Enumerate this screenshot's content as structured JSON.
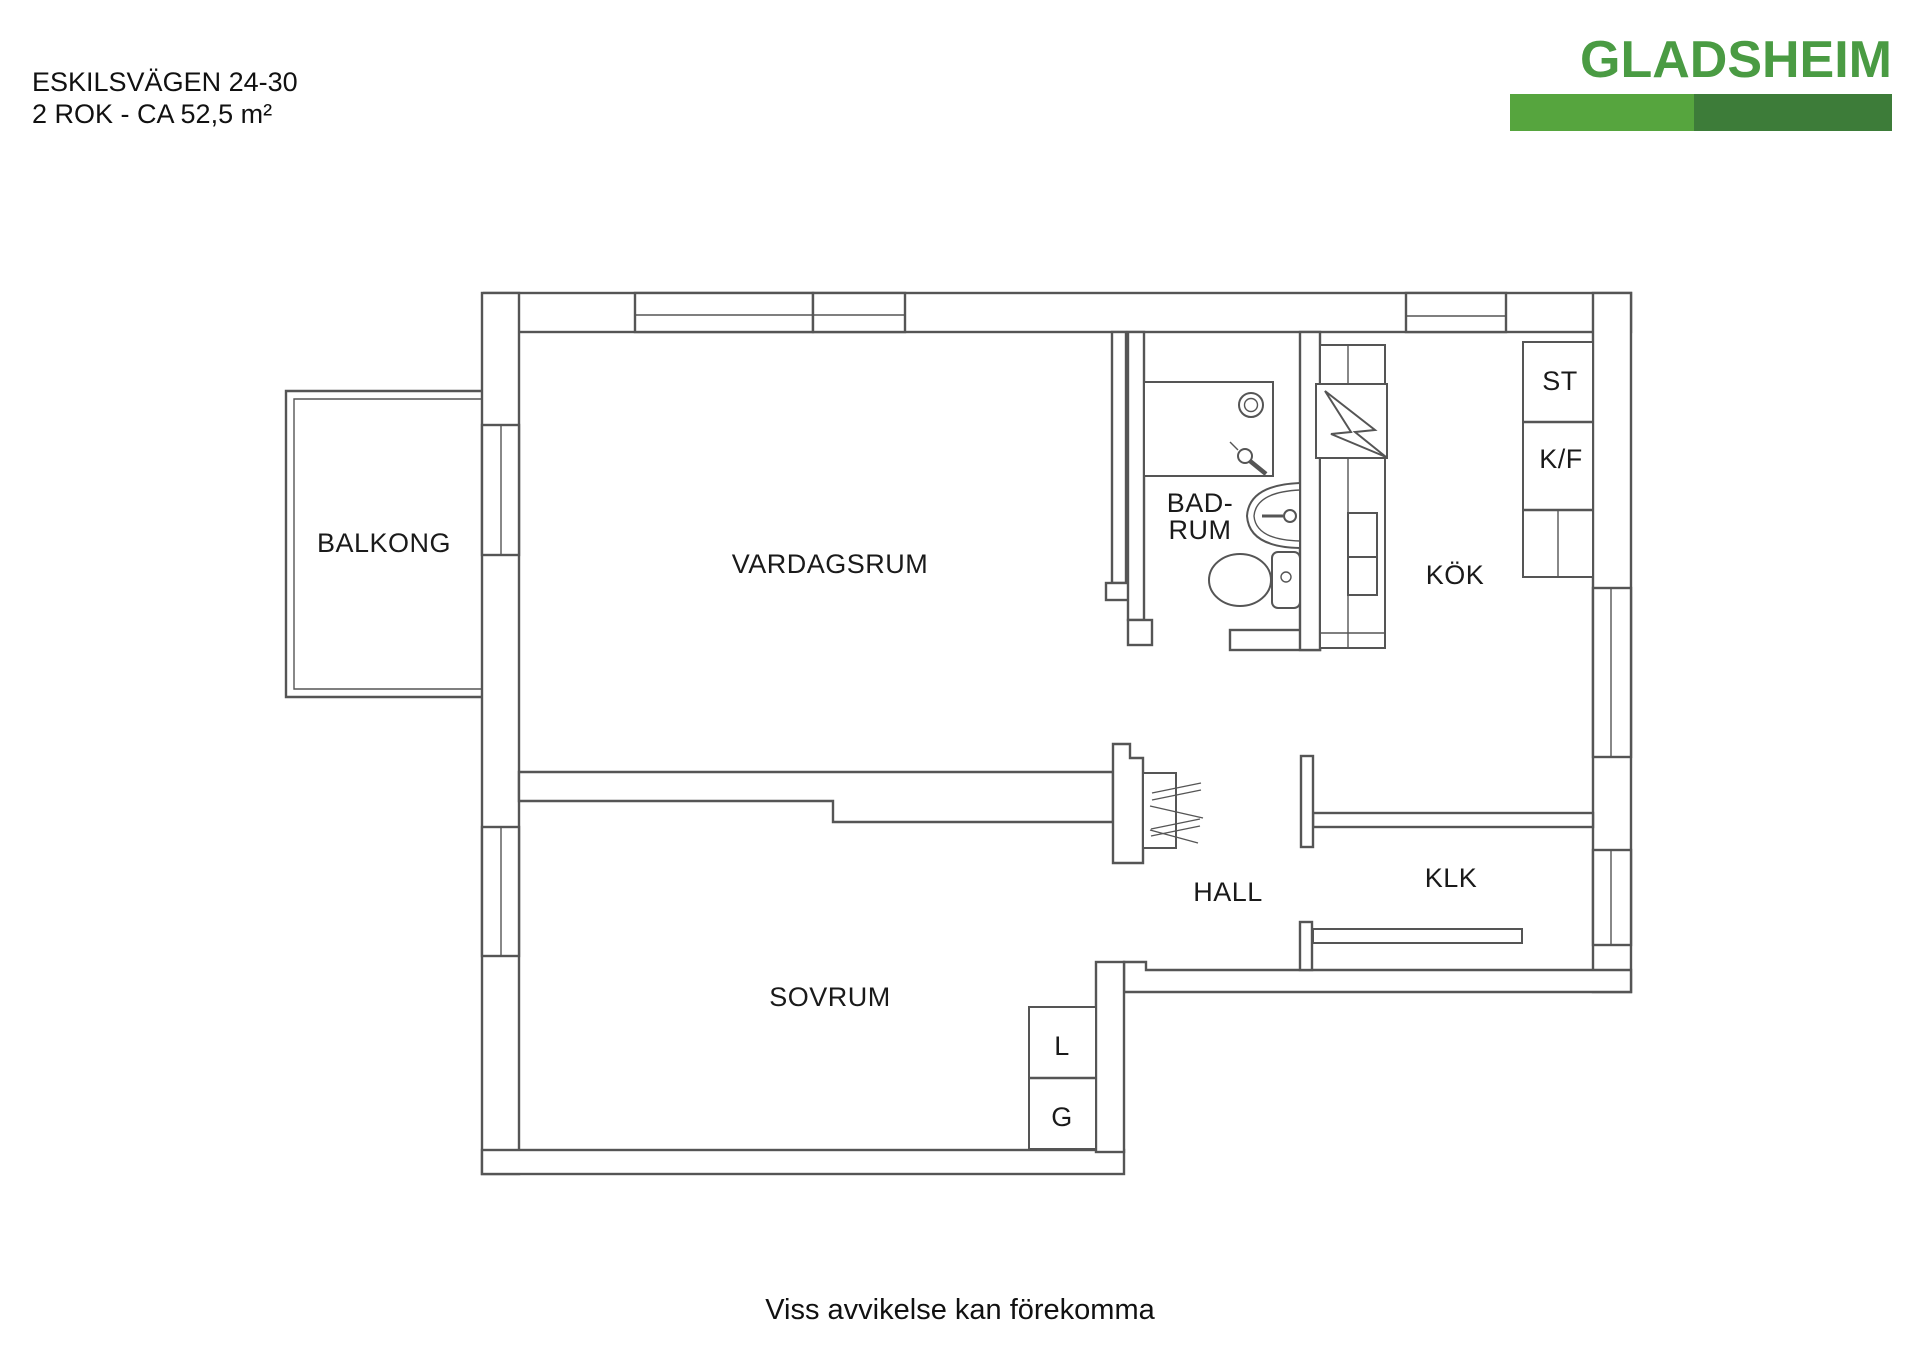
{
  "header": {
    "address": "ESKILSVÄGEN 24-30",
    "specs": "2 ROK - CA 52,5 m²"
  },
  "logo": {
    "name": "GLADSHEIM",
    "text_color": "#4a9b43",
    "bar_left_color": "#56a53e",
    "bar_right_color": "#3d7c39"
  },
  "floorplan": {
    "line_color": "#555555",
    "labels": {
      "balcony": "BALKONG",
      "living_room": "VARDAGSRUM",
      "bathroom_line1": "BAD-",
      "bathroom_line2": "RUM",
      "kitchen": "KÖK",
      "cleaning_closet": "ST",
      "fridge_freezer": "K/F",
      "hall": "HALL",
      "walk_in_closet": "KLK",
      "bedroom": "SOVRUM",
      "linen_closet": "L",
      "wardrobe": "G"
    }
  },
  "footer": {
    "disclaimer": "Viss avvikelse kan förekomma"
  }
}
